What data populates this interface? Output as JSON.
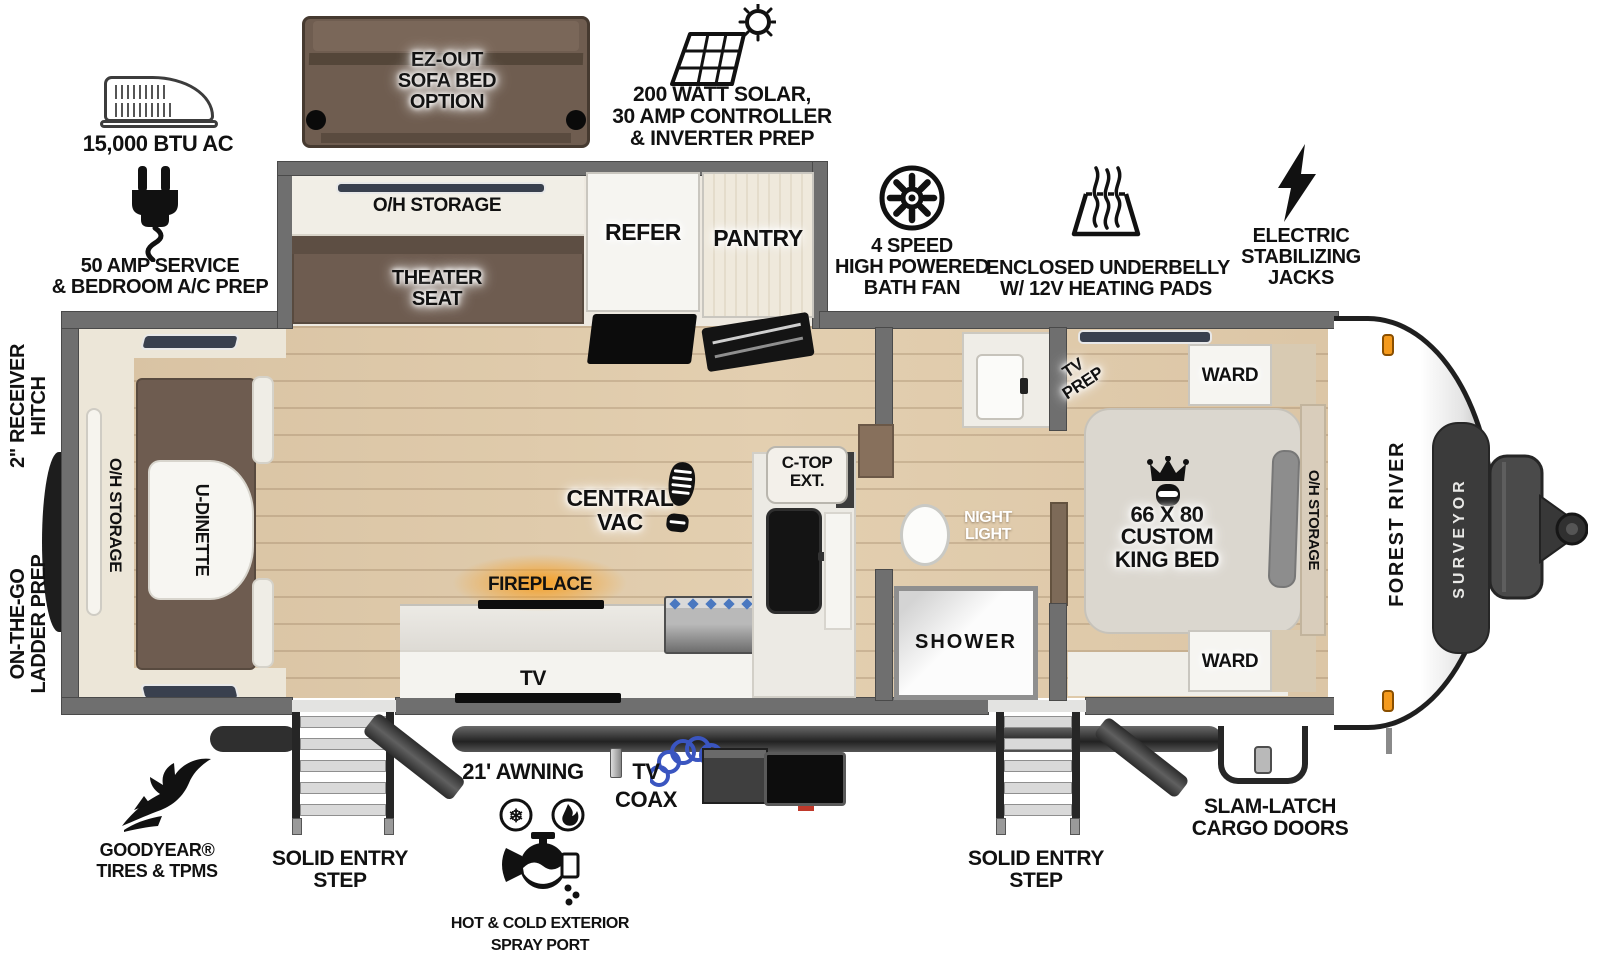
{
  "colors": {
    "wall": "#6f6f6f",
    "floor_wood": "#dcc6a6",
    "cabinet_cream": "#ece6d8",
    "furniture_brown": "#6e5c50",
    "fireplace_orange": "#f59d1e",
    "amber_marker_light": "#f59a1c",
    "coax_blue": "#3a55c0",
    "surveyor_badge": "#3b3b3b"
  },
  "callouts": {
    "ac": {
      "label": "15,000 BTU AC"
    },
    "solar": {
      "line1": "200 WATT SOLAR,",
      "line2": "30 AMP CONTROLLER",
      "line3": "& INVERTER PREP"
    },
    "amp50": {
      "line1": "50 AMP SERVICE",
      "line2": "& BEDROOM A/C PREP"
    },
    "bath_fan": {
      "line1": "4 SPEED",
      "line2": "HIGH POWERED",
      "line3": "BATH FAN"
    },
    "underbelly": {
      "line1": "ENCLOSED UNDERBELLY",
      "line2": "W/ 12V HEATING PADS"
    },
    "jacks": {
      "line1": "ELECTRIC",
      "line2": "STABILIZING",
      "line3": "JACKS"
    },
    "receiver_hitch": {
      "line1": "2\" RECEIVER",
      "line2": "HITCH"
    },
    "ladder_prep": {
      "line1": "ON-THE-GO",
      "line2": "LADDER PREP"
    },
    "goodyear": {
      "line1": "GOODYEAR®",
      "line2": "TIRES & TPMS"
    },
    "entry_step_rear": {
      "line1": "SOLID ENTRY",
      "line2": "STEP"
    },
    "entry_step_front": {
      "line1": "SOLID ENTRY",
      "line2": "STEP"
    },
    "awning": {
      "label": "21' AWNING"
    },
    "tv_coax": {
      "line1": "TV",
      "line2": "COAX"
    },
    "spray_port": {
      "line1": "HOT & COLD EXTERIOR",
      "line2": "SPRAY PORT"
    },
    "slam_latch": {
      "line1": "SLAM-LATCH",
      "line2": "CARGO DOORS"
    }
  },
  "rooms": {
    "ez_sofa": {
      "line1": "EZ-OUT",
      "line2": "SOFA BED",
      "line3": "OPTION"
    },
    "slide_oh_storage": "O/H STORAGE",
    "theater_seat": {
      "line1": "THEATER",
      "line2": "SEAT"
    },
    "refer": "REFER",
    "pantry": "PANTRY",
    "central_vac": {
      "line1": "CENTRAL",
      "line2": "VAC"
    },
    "ctop_ext": {
      "line1": "C-TOP",
      "line2": "EXT."
    },
    "fireplace": "FIREPLACE",
    "tv": "TV",
    "u_dinette": "U-DINETTE",
    "rear_oh_storage": "O/H STORAGE",
    "night_light": {
      "line1": "NIGHT",
      "line2": "LIGHT"
    },
    "shower": "SHOWER",
    "tv_prep": {
      "line1": "TV",
      "line2": "PREP"
    },
    "ward_top": "WARD",
    "ward_bottom": "WARD",
    "king_bed": {
      "line1": "66 X 80",
      "line2": "CUSTOM",
      "line3": "KING BED"
    },
    "bed_oh_storage": "O/H STORAGE"
  },
  "branding": {
    "make": "FOREST RIVER",
    "model": "SURVEYOR"
  },
  "icons": {
    "snowflake": "❄"
  }
}
